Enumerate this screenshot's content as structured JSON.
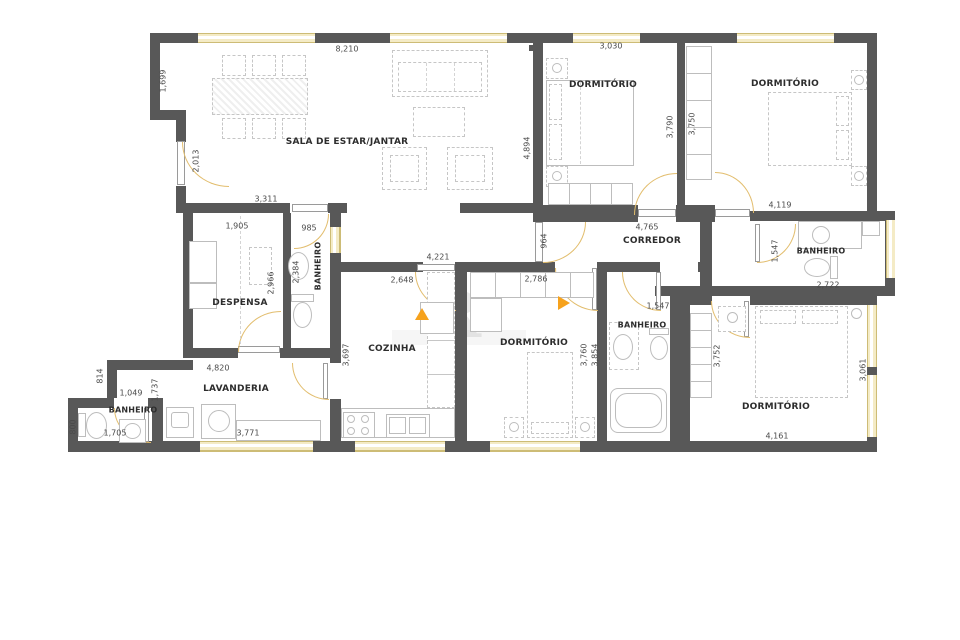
{
  "type": "apartment-floor-plan",
  "rooms": {
    "sala": "SALA DE ESTAR/JANTAR",
    "dormitorio_1": "DORMITÓRIO",
    "dormitorio_2": "DORMITÓRIO",
    "corredor": "CORREDOR",
    "banheiro_suite": "BANHEIRO",
    "despensa": "DESPENSA",
    "banheiro_social": "BANHEIRO",
    "cozinha": "COZINHA",
    "dormitorio_3": "DORMITÓRIO",
    "banheiro_3": "BANHEIRO",
    "dormitorio_4": "DORMITÓRIO",
    "lavanderia": "LAVANDERIA",
    "banheiro_servico": "BANHEIRO"
  },
  "dims": {
    "sala_top": "8,210",
    "sala_left_upper": "1,699",
    "sala_entry": "2,013",
    "sala_bottom": "3,311",
    "despensa_top": "1,905",
    "banheiro_social_top": "985",
    "sala_right": "4,894",
    "dorm1_top": "3,030",
    "dorm1_closet": "3,790",
    "dorm2_closet": "3,750",
    "corredor_length": "4,765",
    "corredor_width": "964",
    "dorm2_width": "4,119",
    "banheiro_suite_entry": "1,547",
    "banheiro_suite_width": "2,722",
    "despensa_height": "2,966",
    "banheiro_social_height": "2,384",
    "passage_width": "4,221",
    "cozinha_width": "2,648",
    "cozinha_height": "3,697",
    "dorm3_width": "2,786",
    "dorm3_height": "3,760",
    "banheiro3_width": "1,547",
    "banheiro3_height": "3,854",
    "dorm4_height": "3,752",
    "dorm4_window": "3,061",
    "dorm4_width": "4,161",
    "lavanderia_width": "4,820",
    "hall_height": "814",
    "hall_width": "1,049",
    "lavanderia_height": "1,737",
    "banheiro_servico_height": "800",
    "banheiro_servico_width": "1,705",
    "lavanderia_counter": "3,771"
  },
  "colors": {
    "wall": "#585858",
    "window": "#f4ebc6",
    "door_arc": "#e2bd6d",
    "arrow": "#f6a21d",
    "furniture_line": "#c6c6c6",
    "text": "#2d2d2d"
  },
  "watermark": "R"
}
